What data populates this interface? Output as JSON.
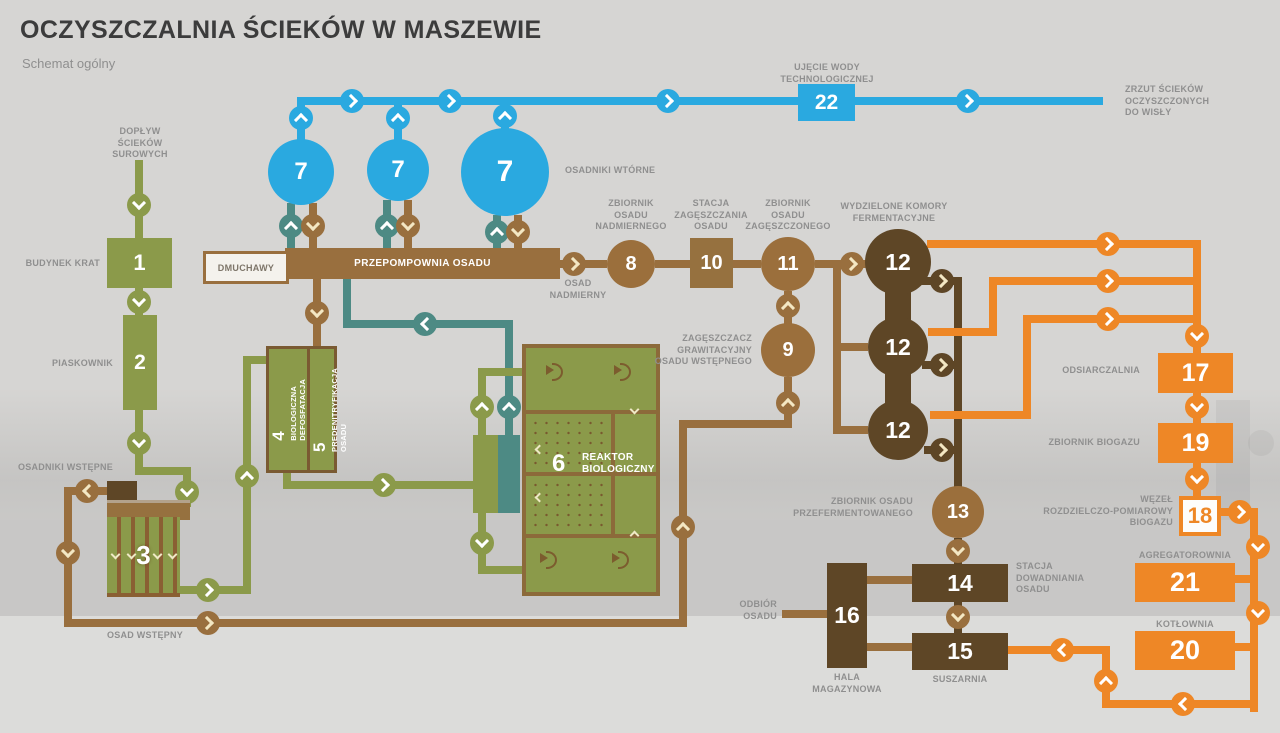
{
  "title": "OCZYSZCZALNIA ŚCIEKÓW W MASZEWIE",
  "subtitle": "Schemat ogólny",
  "colors": {
    "blue": "#2aa9e0",
    "teal": "#4d8a84",
    "green": "#8b9a4a",
    "brown": "#996f3e",
    "dark_brown": "#5e4626",
    "orange": "#ee8726",
    "label_gray": "#8f8f8f",
    "background": "#d6d5d3"
  },
  "icons": {
    "chevron": "angle-bracket-in-circle",
    "fan": "aerator-fan"
  },
  "nums": {
    "n1": "1",
    "n2": "2",
    "n3": "3",
    "n4": "4",
    "n5": "5",
    "n6": "6",
    "n7": "7",
    "n8": "8",
    "n9": "9",
    "n10": "10",
    "n11": "11",
    "n12": "12",
    "n13": "13",
    "n14": "14",
    "n15": "15",
    "n16": "16",
    "n17": "17",
    "n18": "18",
    "n19": "19",
    "n20": "20",
    "n21": "21",
    "n22": "22"
  },
  "labels": {
    "doplyw": [
      "DOPŁYW",
      "ŚCIEKÓW",
      "SUROWYCH"
    ],
    "budynek_krat": [
      "BUDYNEK KRAT"
    ],
    "piaskownik": [
      "PIASKOWNIK"
    ],
    "osadniki_wstepne": [
      "OSADNIKI WSTĘPNE"
    ],
    "osad_wstepny": [
      "OSAD WSTĘPNY"
    ],
    "dmuchawy": [
      "DMUCHAWY"
    ],
    "przepompownia": [
      "PRZEPOMPOWNIA OSADU"
    ],
    "osadniki_wtorne": [
      "OSADNIKI WTÓRNE"
    ],
    "ujecie": [
      "UJĘCIE WODY",
      "TECHNOLOGICZNEJ"
    ],
    "zrzut": [
      "ZRZUT ŚCIEKÓW",
      "OCZYSZCZONYCH",
      "DO WISŁY"
    ],
    "osad_nadmierny": [
      "OSAD",
      "NADMIERNY"
    ],
    "zb_nadmiernego": [
      "ZBIORNIK",
      "OSADU",
      "NADMIERNEGO"
    ],
    "stacja_zag": [
      "STACJA",
      "ZAGĘSZCZANIA",
      "OSADU"
    ],
    "zb_zageszczonego": [
      "ZBIORNIK",
      "OSADU",
      "ZAGĘSZCZONEGO"
    ],
    "komory": [
      "WYDZIELONE KOMORY",
      "FERMENTACYJNE"
    ],
    "zageszczacz": [
      "ZAGĘSZCZACZ",
      "GRAWITACYJNY",
      "OSADU WSTĘPNEGO"
    ],
    "reaktor": [
      "REAKTOR",
      "BIOLOGICZNY"
    ],
    "defosfatacja": [
      "BIOLOGICZNA",
      "DEFOSFATACJA"
    ],
    "predenitryfikacja": [
      "PREDENITRYFIKACJA",
      "OSADU"
    ],
    "odsiarczalnia": [
      "ODSIARCZALNIA"
    ],
    "zb_biogazu": [
      "ZBIORNIK BIOGAZU"
    ],
    "wezel": [
      "WĘZEŁ",
      "ROZDZIELCZO-POMIAROWY",
      "BIOGAZU"
    ],
    "agregatorownia": [
      "AGREGATOROWNIA"
    ],
    "kotlownia": [
      "KOTŁOWNIA"
    ],
    "zb_przeferm": [
      "ZBIORNIK OSADU",
      "PRZEFERMENTOWANEGO"
    ],
    "stacja_odw": [
      "STACJA",
      "DOWADNIANIA",
      "OSADU"
    ],
    "suszarnia": [
      "SUSZARNIA"
    ],
    "hala": [
      "HALA",
      "MAGAZYNOWA"
    ],
    "odbior": [
      "ODBIÓR",
      "OSADU"
    ]
  }
}
